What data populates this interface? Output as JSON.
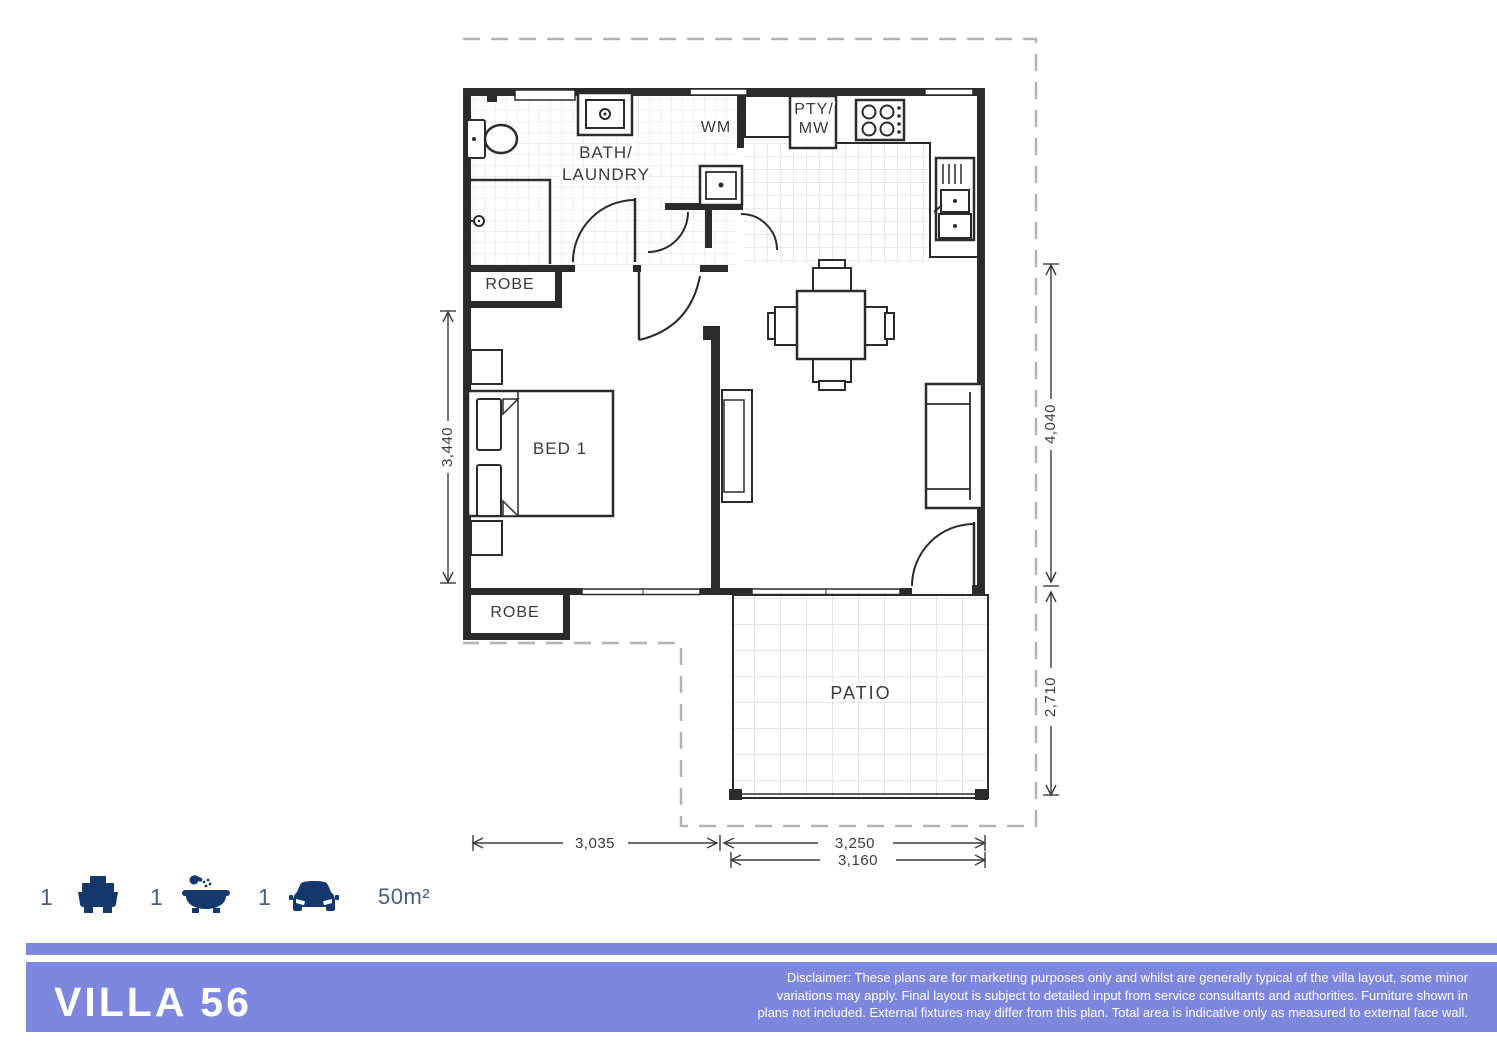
{
  "plan": {
    "rooms": {
      "bath_line1": "BATH/",
      "bath_line2": "LAUNDRY",
      "wm": "WM",
      "pty_line1": "PTY/",
      "pty_line2": "MW",
      "robe_top": "ROBE",
      "bed1": "BED 1",
      "robe_bottom": "ROBE",
      "patio": "PATIO"
    },
    "dimensions": {
      "bedroom_height": "3,440",
      "living_height": "4,040",
      "patio_height": "2,710",
      "bedroom_width": "3,035",
      "living_width": "3,250",
      "patio_width": "3,160"
    }
  },
  "summary": {
    "beds": {
      "count": "1",
      "icon": "bed-icon"
    },
    "baths": {
      "count": "1",
      "icon": "bath-icon"
    },
    "cars": {
      "count": "1",
      "icon": "car-icon"
    },
    "area": "50m²"
  },
  "footer": {
    "title": "VILLA 56",
    "disclaimer_line1": "Disclaimer: These plans are for marketing purposes only and whilst are generally typical of the villa layout, some minor",
    "disclaimer_line2": "variations may apply. Final layout is subject to detailed input from service consultants and authorities. Furniture shown in",
    "disclaimer_line3": "plans not included. External fixtures may differ from this plan. Total area is indicative only as measured to external face wall."
  },
  "colors": {
    "accent_purple": "#7d87de",
    "icon_navy": "#14386c",
    "wall_black": "#2b2b2b",
    "dimension_gray": "#3c3c3c",
    "boundary_dash": "#b3b3b3",
    "summary_text": "#46607d"
  }
}
